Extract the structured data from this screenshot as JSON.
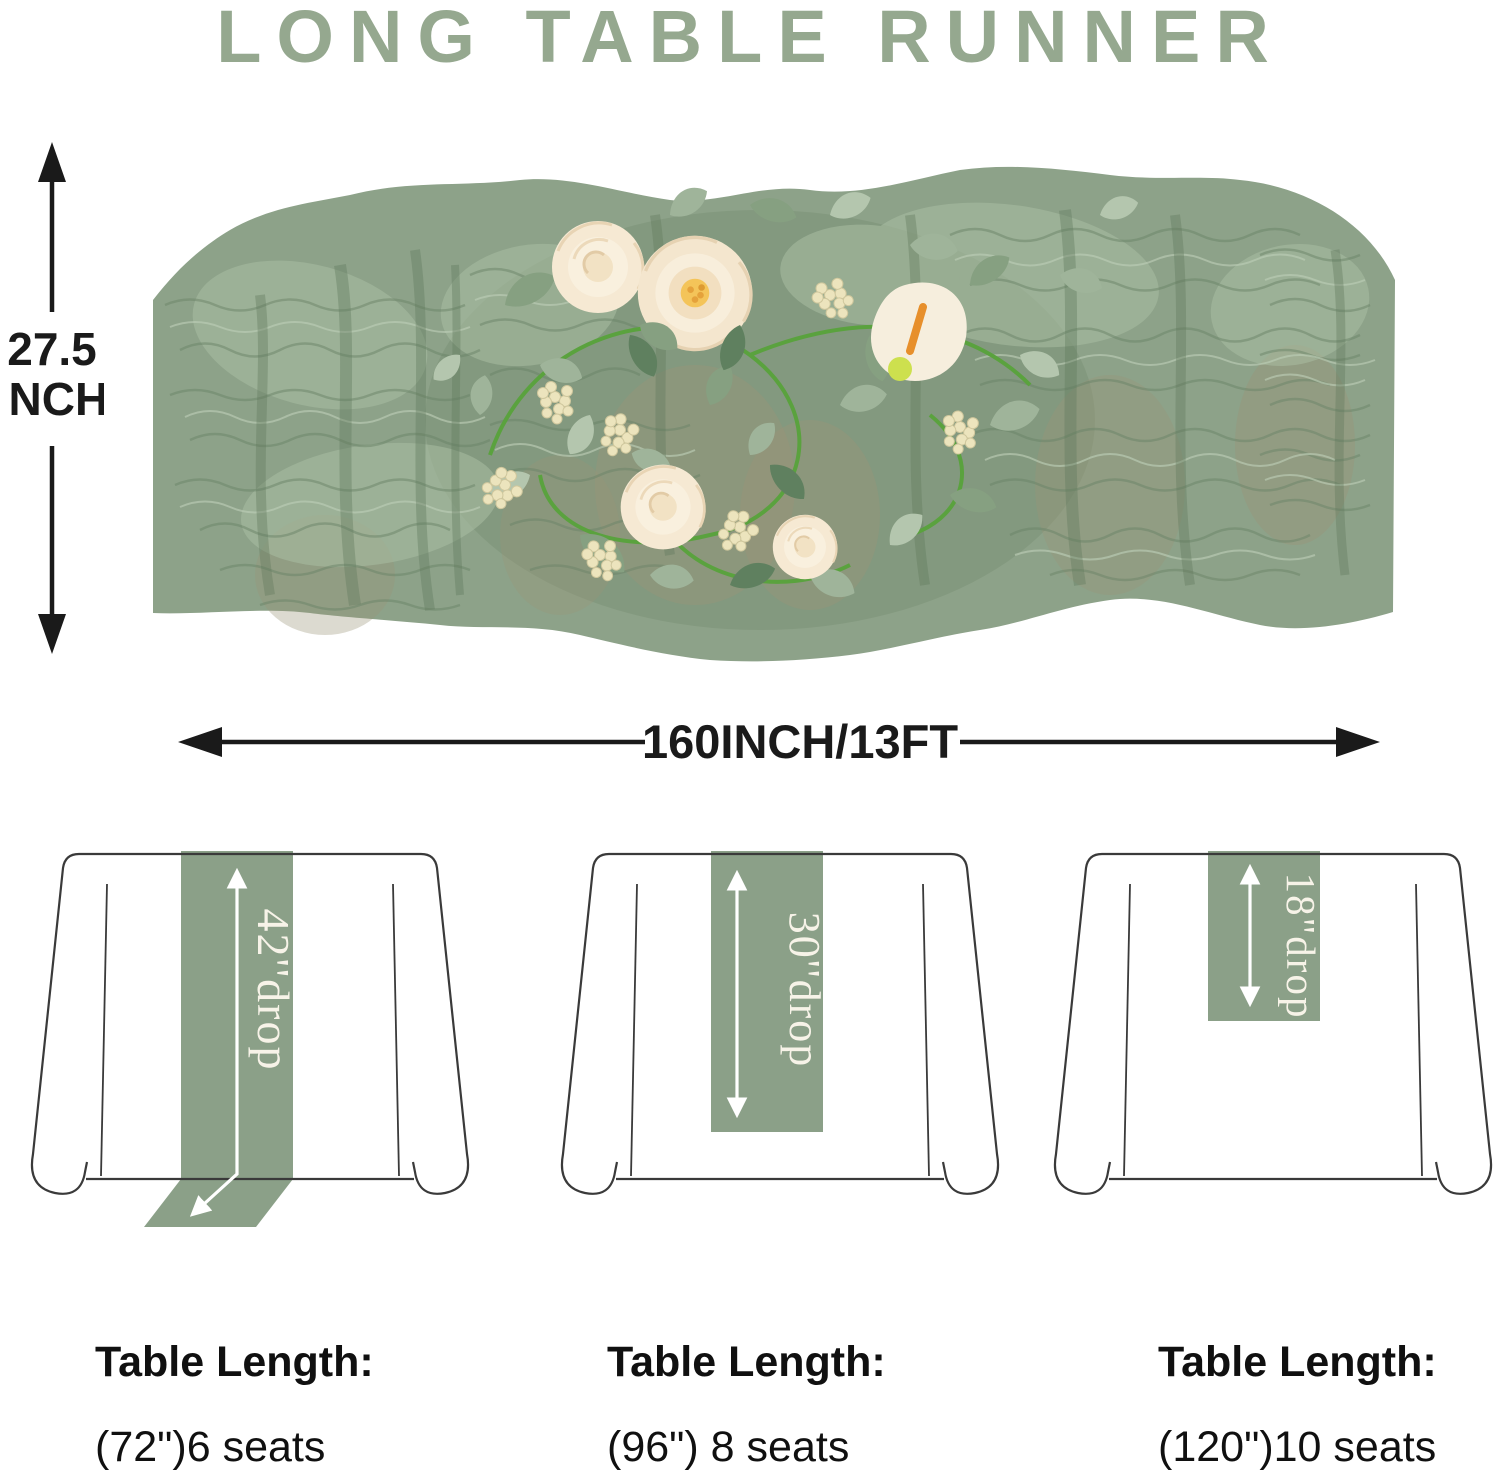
{
  "title": "LONG TABLE RUNNER",
  "runner_photo": {
    "description": "Sage green crinkled cheesecloth gauze table runner decorated with a garland of cream roses, eucalyptus leaves and cream berry clusters"
  },
  "dimensions": {
    "height_value": "27.5",
    "height_unit": "INCH",
    "length_label": "160INCH/13FT"
  },
  "diagrams": [
    {
      "drop_label": "42''drop",
      "length_title": "Table Length:",
      "seats": "(72\")6 seats"
    },
    {
      "drop_label": "30''drop",
      "length_title": "Table Length:",
      "seats": "(96\") 8 seats"
    },
    {
      "drop_label": "18\"drop",
      "length_title": "Table Length:",
      "seats": "(120\")10 seats"
    }
  ],
  "colors": {
    "title_green": "#95a88f",
    "runner_green": "#8ba088",
    "fabric_sage": "#8da289",
    "fabric_shadow": "#6b8468",
    "flower_cream": "#f6e9d3",
    "flower_center_yellow": "#f4c459",
    "leaf_green": "#86a081",
    "berry_cream": "#ece4bd",
    "drop_label_white": "#f7f3e8",
    "outline_gray": "#3a3a3a",
    "dimension_black": "#1a1a1a"
  }
}
